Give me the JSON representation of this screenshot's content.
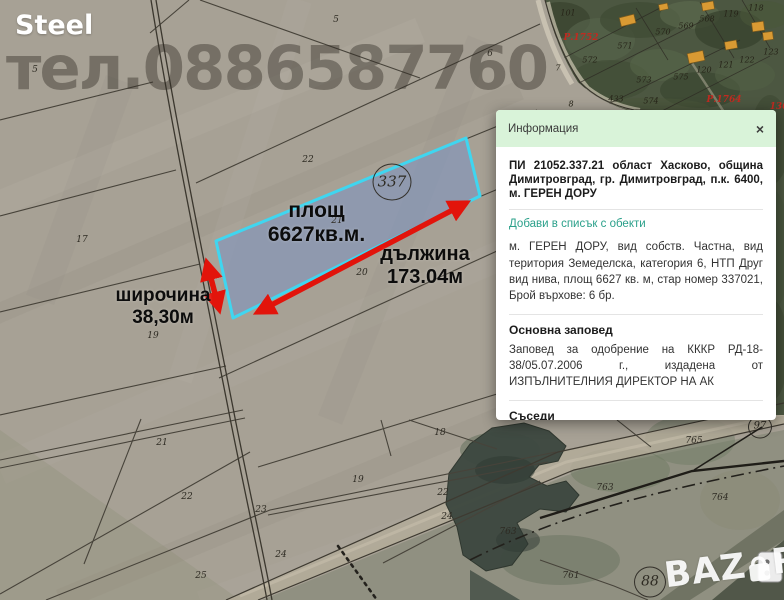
{
  "watermarks": {
    "seller": "Steel",
    "phone": "тел.0886587760",
    "logo_left": "BAZ",
    "logo_right": "R"
  },
  "measurements": {
    "area_label": "площ",
    "area_value": "6627кв.м.",
    "length_label": "дължина",
    "length_value": "173.04м",
    "width_label": "широчина",
    "width_value": "38,30м"
  },
  "info_panel": {
    "title": "Информация",
    "close_label": "×",
    "address": "ПИ 21052.337.21 област Хасково, община Димитровград, гр. Димитровград, п.к. 6400, м. ГЕРЕН ДОРУ",
    "add_link": "Добави в списък с обекти",
    "description": "м. ГЕРЕН ДОРУ, вид собств. Частна, вид територия Земеделска, категория 6, НТП Друг вид нива, площ 6627 кв. м, стар номер 337021, Брой върхове: 6 бр.",
    "order_heading": "Основна заповед",
    "order_text": "Заповед за одобрение на КККР РД-18-38/05.07.2006 г., издадена от ИЗПЪЛНИТЕЛНИЯ ДИРЕКТОР НА АК",
    "neighbors_heading": "Съседи",
    "neighbors_text": "21052.336.44, 21052.337.7, 21052.337.8, 21052.337.9, 21052.337.20, 21052.337.22"
  },
  "selected_parcel_number": "337",
  "map_labels": [
    {
      "text": "5",
      "x": 336,
      "y": 20,
      "kind": "num"
    },
    {
      "text": "5",
      "x": 35,
      "y": 70,
      "kind": "num"
    },
    {
      "text": "6",
      "x": 490,
      "y": 54,
      "kind": "num"
    },
    {
      "text": "22",
      "x": 308,
      "y": 160,
      "kind": "num"
    },
    {
      "text": "17",
      "x": 82,
      "y": 240,
      "kind": "num"
    },
    {
      "text": "21",
      "x": 337,
      "y": 221,
      "kind": "num"
    },
    {
      "text": "20",
      "x": 362,
      "y": 273,
      "kind": "num"
    },
    {
      "text": "19",
      "x": 153,
      "y": 336,
      "kind": "num"
    },
    {
      "text": "18",
      "x": 440,
      "y": 433,
      "kind": "num"
    },
    {
      "text": "19",
      "x": 358,
      "y": 480,
      "kind": "num"
    },
    {
      "text": "22",
      "x": 443,
      "y": 493,
      "kind": "num"
    },
    {
      "text": "23",
      "x": 261,
      "y": 510,
      "kind": "num"
    },
    {
      "text": "24",
      "x": 447,
      "y": 517,
      "kind": "num"
    },
    {
      "text": "24",
      "x": 281,
      "y": 555,
      "kind": "num"
    },
    {
      "text": "25",
      "x": 201,
      "y": 576,
      "kind": "num"
    },
    {
      "text": "21",
      "x": 162,
      "y": 443,
      "kind": "num"
    },
    {
      "text": "22",
      "x": 187,
      "y": 497,
      "kind": "num"
    },
    {
      "text": "763",
      "x": 508,
      "y": 532,
      "kind": "num"
    },
    {
      "text": "763",
      "x": 605,
      "y": 488,
      "kind": "num"
    },
    {
      "text": "765",
      "x": 694,
      "y": 441,
      "kind": "num"
    },
    {
      "text": "764",
      "x": 720,
      "y": 498,
      "kind": "num"
    },
    {
      "text": "761",
      "x": 571,
      "y": 576,
      "kind": "num"
    },
    {
      "text": "101",
      "x": 568,
      "y": 13,
      "kind": "num-sm"
    },
    {
      "text": "570",
      "x": 663,
      "y": 32,
      "kind": "num-sm"
    },
    {
      "text": "569",
      "x": 686,
      "y": 26,
      "kind": "num-sm"
    },
    {
      "text": "568",
      "x": 707,
      "y": 19,
      "kind": "num-sm"
    },
    {
      "text": "119",
      "x": 731,
      "y": 14,
      "kind": "num-sm"
    },
    {
      "text": "118",
      "x": 756,
      "y": 8,
      "kind": "num-sm"
    },
    {
      "text": "571",
      "x": 625,
      "y": 46,
      "kind": "num-sm"
    },
    {
      "text": "572",
      "x": 590,
      "y": 60,
      "kind": "num-sm"
    },
    {
      "text": "573",
      "x": 644,
      "y": 80,
      "kind": "num-sm"
    },
    {
      "text": "575",
      "x": 681,
      "y": 77,
      "kind": "num-sm"
    },
    {
      "text": "574",
      "x": 651,
      "y": 101,
      "kind": "num-sm"
    },
    {
      "text": "433",
      "x": 616,
      "y": 99,
      "kind": "num-sm"
    },
    {
      "text": "120",
      "x": 704,
      "y": 70,
      "kind": "num-sm"
    },
    {
      "text": "121",
      "x": 726,
      "y": 65,
      "kind": "num-sm"
    },
    {
      "text": "122",
      "x": 747,
      "y": 60,
      "kind": "num-sm"
    },
    {
      "text": "123",
      "x": 771,
      "y": 52,
      "kind": "num-sm"
    },
    {
      "text": "7",
      "x": 558,
      "y": 68,
      "kind": "num-sm"
    },
    {
      "text": "8",
      "x": 571,
      "y": 104,
      "kind": "num-sm"
    },
    {
      "text": "Р.1752",
      "x": 581,
      "y": 38,
      "kind": "red"
    },
    {
      "text": "Р.1764",
      "x": 724,
      "y": 100,
      "kind": "red"
    },
    {
      "text": "136",
      "x": 779,
      "y": 107,
      "kind": "red"
    },
    {
      "text": "337",
      "x": 392,
      "y": 182,
      "kind": "circle-lg"
    },
    {
      "text": "88",
      "x": 650,
      "y": 582,
      "kind": "circle"
    },
    {
      "text": "97",
      "x": 760,
      "y": 427,
      "kind": "circle-sm"
    }
  ],
  "colors": {
    "selection_fill": "#7b94c2",
    "selection_border": "#3fd6f0",
    "arrow_red": "#e2140b",
    "panel_header_bg": "#d9f3d9",
    "add_link_green": "#2aa08a"
  }
}
